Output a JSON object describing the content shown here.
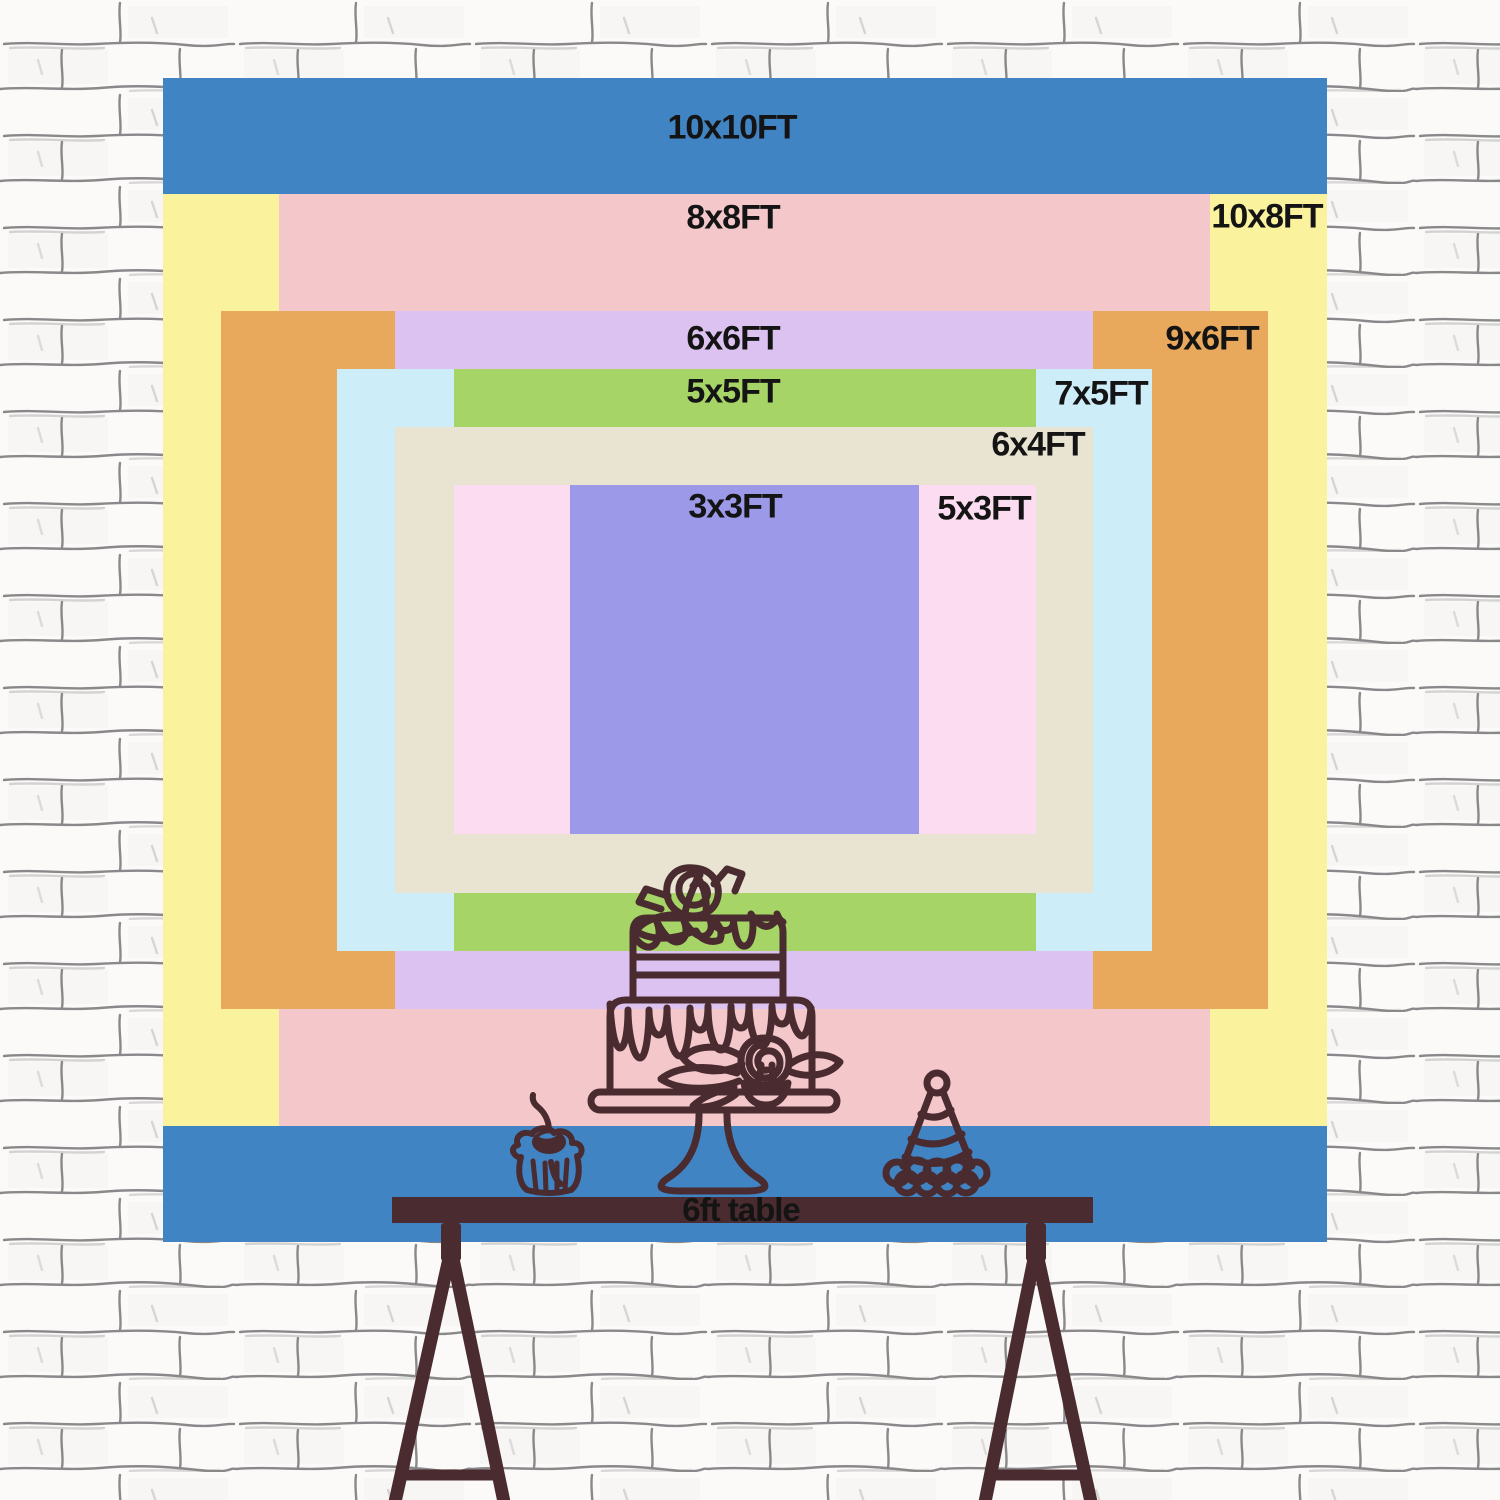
{
  "backdrop": {
    "layers": [
      {
        "size": "10x10FT",
        "color": "#4184c4"
      },
      {
        "size": "10x8FT",
        "color": "#fbf29d"
      },
      {
        "size": "8x8FT",
        "color": "#f4c8ca"
      },
      {
        "size": "9x6FT",
        "color": "#e9a95c"
      },
      {
        "size": "6x6FT",
        "color": "#dcc2f0"
      },
      {
        "size": "7x5FT",
        "color": "#cdedf9"
      },
      {
        "size": "5x5FT",
        "color": "#a7d466"
      },
      {
        "size": "6x4FT",
        "color": "#e9e4d2"
      },
      {
        "size": "5x3FT",
        "color": "#fcdcf0"
      },
      {
        "size": "3x3FT",
        "color": "#9b99e8"
      }
    ]
  },
  "table": {
    "label": "6ft table"
  },
  "illustration": {
    "line_color": "#4a2b2f",
    "items": [
      "tiered-cake-icon",
      "cupcake-icon",
      "party-hat-icon",
      "trestle-table-icon"
    ]
  },
  "wall": {
    "line_color": "#8a888a",
    "base_color": "#fbfaf8"
  },
  "text_color": "#141414"
}
